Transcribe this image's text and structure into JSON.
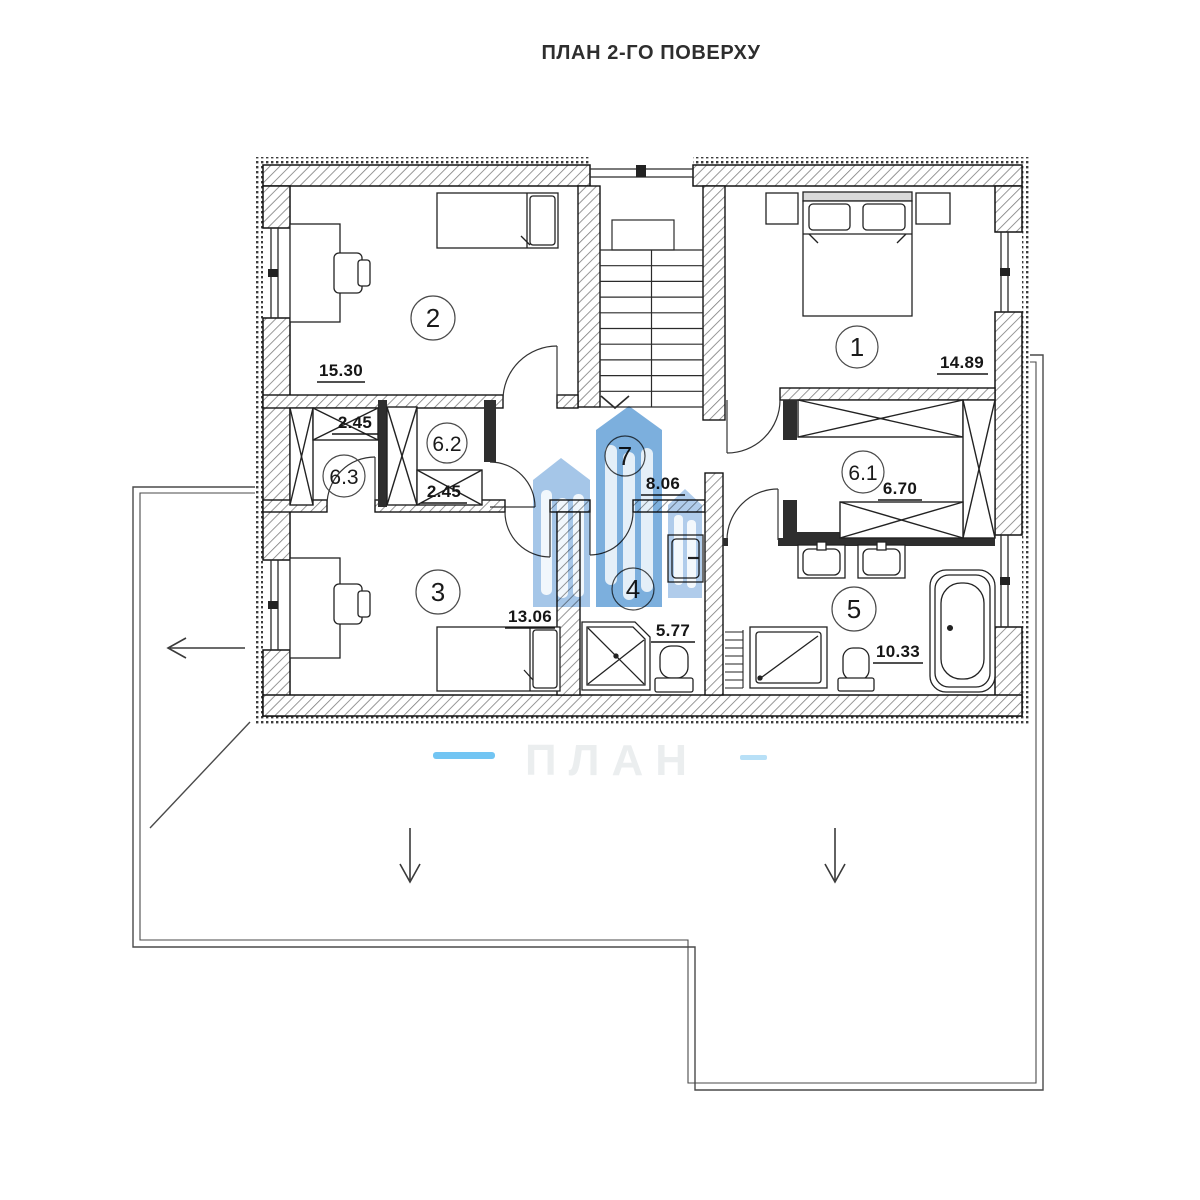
{
  "title": "ПЛАН 2-ГО ПОВЕРХУ",
  "rooms": {
    "r1": {
      "number": "1",
      "area": "14.89"
    },
    "r2": {
      "number": "2",
      "area": "15.30"
    },
    "r3": {
      "number": "3",
      "area": "13.06"
    },
    "r4": {
      "number": "4",
      "area": "5.77"
    },
    "r5": {
      "number": "5",
      "area": "10.33"
    },
    "r61": {
      "number": "6.1",
      "area": "6.70"
    },
    "r62": {
      "number": "6.2",
      "area": "2.45"
    },
    "r63": {
      "number": "6.3",
      "area": "2.45"
    },
    "r7": {
      "number": "7",
      "area": "8.06"
    }
  },
  "watermark": {
    "ghost_text": "ПЛАН"
  },
  "colors": {
    "watermark_primary": "#5B9BD5",
    "watermark_secondary": "#8FB8E2",
    "watermark_tertiary": "#9CC0E6",
    "watermark_accent": "#4FB7F0",
    "watermark_accent_light": "#A6D8F5",
    "wall_line": "#1a1a1a"
  }
}
